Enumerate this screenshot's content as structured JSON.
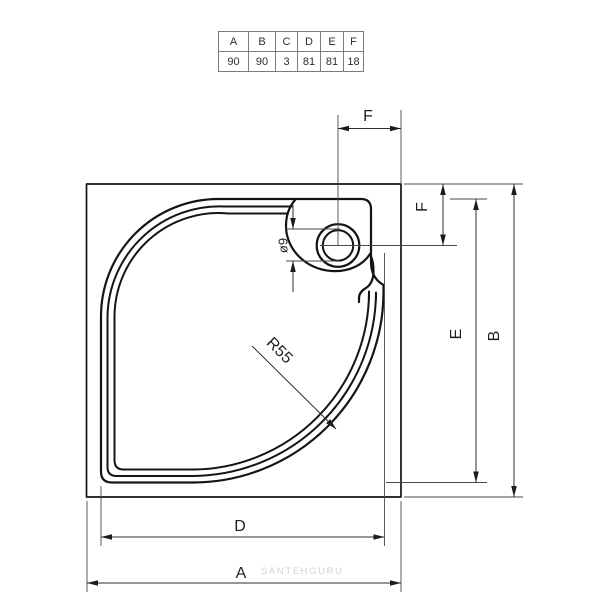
{
  "spec_table": {
    "headers": [
      "A",
      "B",
      "C",
      "D",
      "E",
      "F"
    ],
    "values": [
      "90",
      "90",
      "3",
      "81",
      "81",
      "18"
    ]
  },
  "dimensions": {
    "overall_width_label": "A",
    "overall_depth_label": "B",
    "inner_width_label": "D",
    "inner_depth_label": "E",
    "drain_offset_top_label": "F",
    "drain_offset_side_label": "F",
    "front_radius_label": "R55",
    "drain_diameter_label": "ø9"
  },
  "watermark": "SANTEHGURU",
  "colors": {
    "outline": "#141414",
    "dimension_lines": "#2e2e2e",
    "extension_lines": "#4a4a4a",
    "table_border": "#7b7b7b",
    "watermark": "#d2d2d2",
    "background": "#ffffff"
  }
}
